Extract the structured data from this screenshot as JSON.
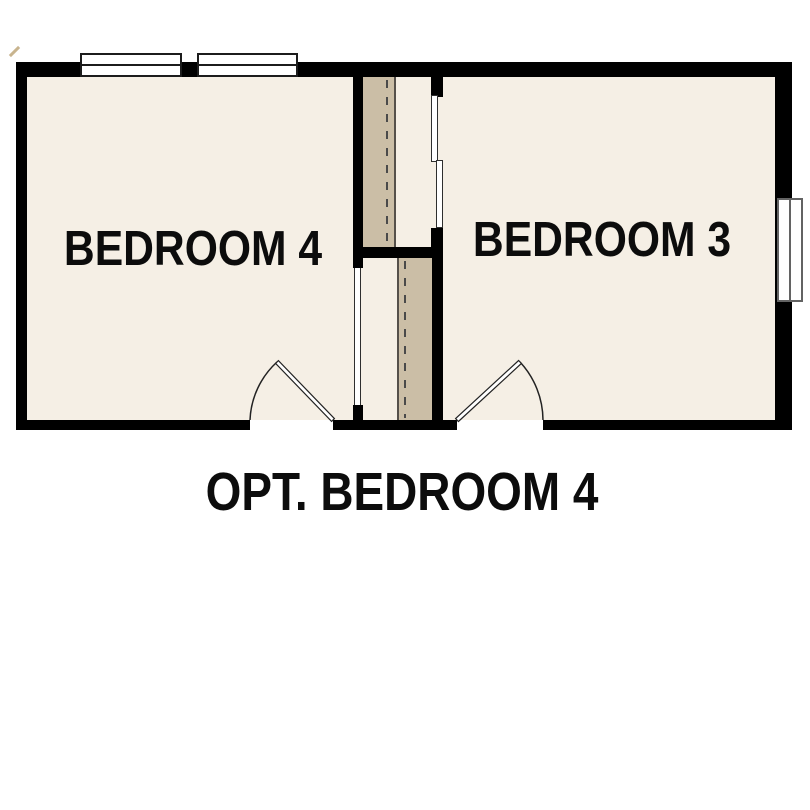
{
  "plan": {
    "rooms": [
      {
        "id": "bedroom-4",
        "label": "BEDROOM 4"
      },
      {
        "id": "bedroom-3",
        "label": "BEDROOM 3"
      }
    ],
    "caption": "OPT. BEDROOM 4",
    "features": [
      "top-window-left",
      "top-window-right",
      "right-window",
      "bedroom-4-door-swing",
      "bedroom-3-door-swing",
      "bedroom-4-closet-opening",
      "bedroom-3-closet-sliding-door",
      "optional-wall-dashed-line-upper",
      "optional-wall-dashed-line-lower"
    ],
    "colors": {
      "background": "#FFFFFF",
      "floor": "#F5EFE5",
      "optional_area": "#CBBEA6",
      "wall": "#000000",
      "line": "#222222"
    }
  }
}
